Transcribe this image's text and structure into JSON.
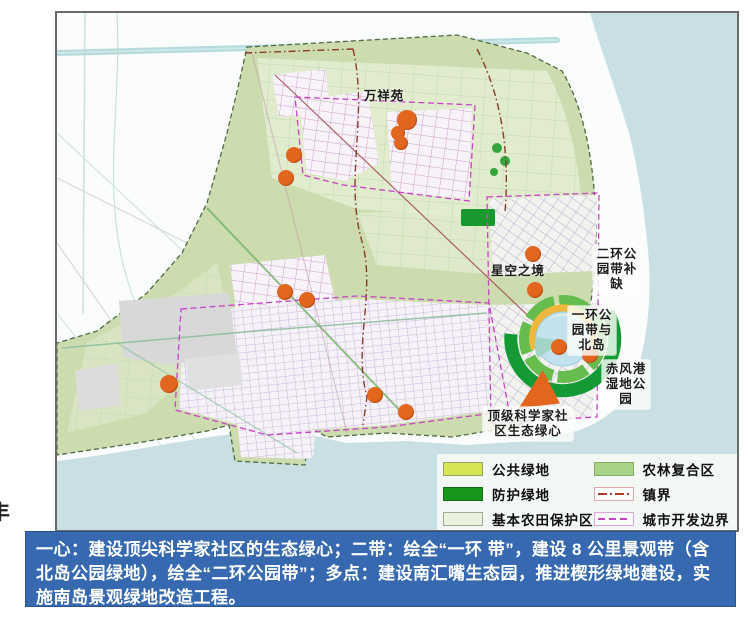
{
  "map": {
    "title": "绿地系统规划图",
    "labels": [
      {
        "id": "wanxiangyuan",
        "text": "万祥苑",
        "x": 300,
        "y": 76,
        "w": 54,
        "chip": false
      },
      {
        "id": "xingkongzhijing",
        "text": "星空之境",
        "x": 434,
        "y": 251,
        "w": 54,
        "chip": false
      },
      {
        "id": "erhuan-gongyuandai-buque",
        "text": "二环公园带补缺",
        "x": 536,
        "y": 232,
        "w": 44,
        "chip": true
      },
      {
        "id": "yihuan-gongyuandai-beidao",
        "text": "一环公园带与北岛",
        "x": 511,
        "y": 293,
        "w": 44,
        "chip": true
      },
      {
        "id": "chifenggang-shidi",
        "text": "赤风港湿地公园",
        "x": 545,
        "y": 347,
        "w": 44,
        "chip": true
      },
      {
        "id": "shengtai-lvxin",
        "text": "顶级科学家社区生态绿心",
        "x": 426,
        "y": 394,
        "w": 86,
        "chip": true
      }
    ],
    "points": [
      {
        "x": 350,
        "y": 107,
        "r": 10
      },
      {
        "x": 341,
        "y": 120,
        "r": 7
      },
      {
        "x": 344,
        "y": 130,
        "r": 7
      },
      {
        "x": 237,
        "y": 142,
        "r": 8
      },
      {
        "x": 229,
        "y": 165,
        "r": 8
      },
      {
        "x": 228,
        "y": 279,
        "r": 8
      },
      {
        "x": 250,
        "y": 287,
        "r": 8
      },
      {
        "x": 112,
        "y": 371,
        "r": 9
      },
      {
        "x": 318,
        "y": 382,
        "r": 8
      },
      {
        "x": 349,
        "y": 399,
        "r": 8
      },
      {
        "x": 476,
        "y": 241,
        "r": 8
      },
      {
        "x": 478,
        "y": 277,
        "r": 8
      },
      {
        "x": 502,
        "y": 334,
        "r": 8
      },
      {
        "x": 533,
        "y": 342,
        "r": 8
      }
    ],
    "wedge": {
      "x": 462,
      "y": 357,
      "w": 41,
      "h": 38
    },
    "colors": {
      "sea": "#c9dfe3",
      "land": "#ccdcae",
      "project_point": "#e2661e",
      "ring_park_green": "#66bd4e",
      "protective_green": "#149a35",
      "lake": "#c2e2ee"
    }
  },
  "legend": {
    "items": [
      {
        "label": "公共绿地",
        "type": "swatch",
        "color": "#d7e453",
        "border": "#9aa06a"
      },
      {
        "label": "防护绿地",
        "type": "swatch",
        "color": "#18961c",
        "border": "#117014"
      },
      {
        "label": "基本农田保护区",
        "type": "swatch",
        "color": "#ebf3dd",
        "border": "#a3a89a"
      },
      {
        "label": "农林复合区",
        "type": "swatch",
        "color": "#a9d488",
        "border": "#88ab6c"
      },
      {
        "label": "镇界",
        "type": "line",
        "color": "#b03a2e",
        "dash": "dashdot",
        "border": "#dfa7a7"
      },
      {
        "label": "城市开发边界",
        "type": "line",
        "color": "#c343c3",
        "dash": "dash",
        "border": "#dca6dc"
      }
    ]
  },
  "caption": {
    "text": "一心：建设顶尖科学家社区的生态绿心；二带：绘全“一环 带”，建设 8 公里景观带（含北岛公园绿地），绘全“二环公园带”；多点：建设南汇嘴生态园，推进楔形绿地建设，实施南岛景观绿地改造工程。"
  },
  "edge_fragment": {
    "text": "丰"
  }
}
